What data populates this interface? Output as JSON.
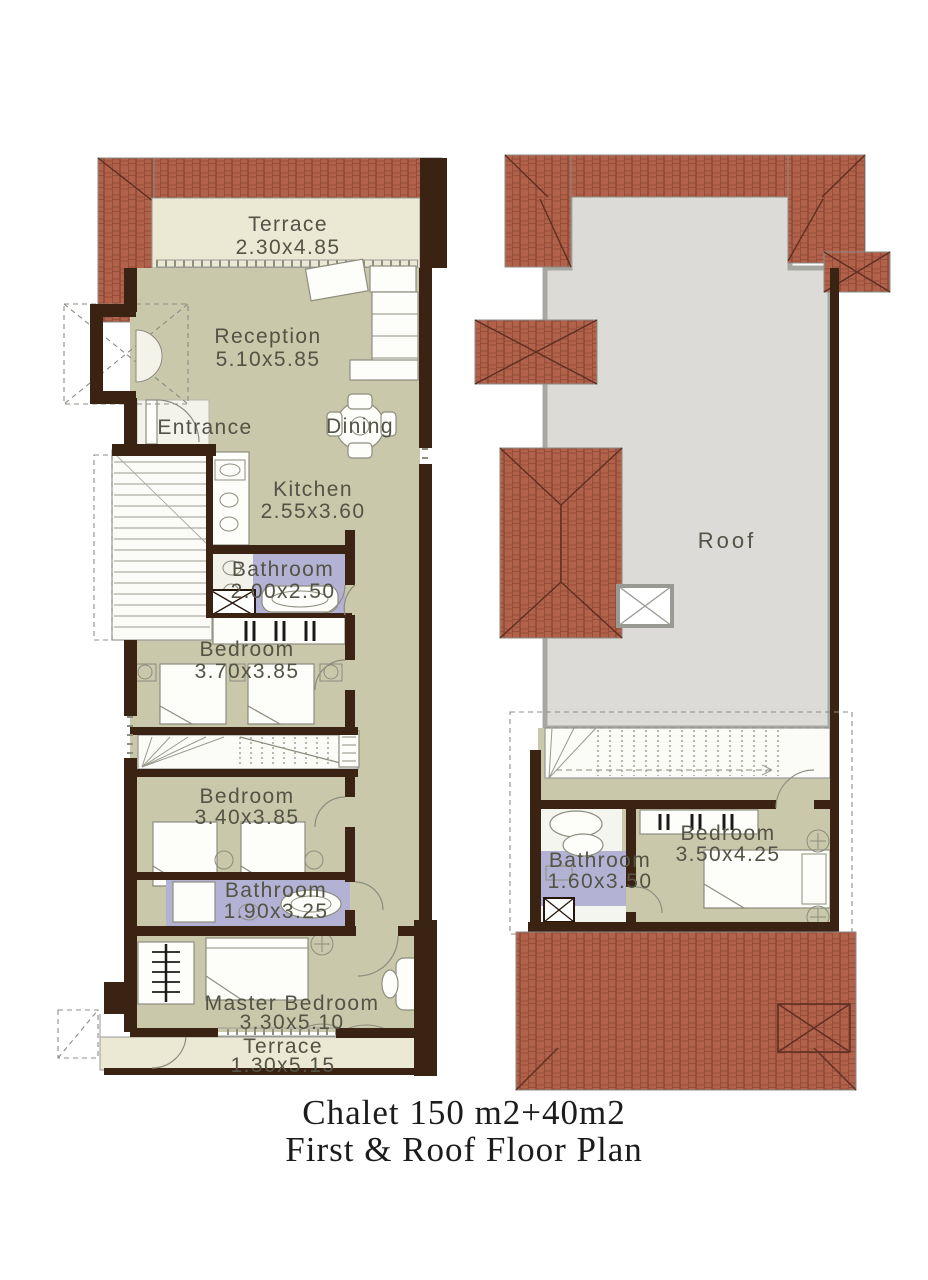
{
  "title": {
    "line1": "Chalet  150 m2+40m2",
    "line2": "First & Roof Floor Plan"
  },
  "first_floor": {
    "terrace_top": {
      "name": "Terrace",
      "dims": "2.30x4.85"
    },
    "reception": {
      "name": "Reception",
      "dims": "5.10x5.85"
    },
    "entrance": {
      "name": "Entrance"
    },
    "dining": {
      "name": "Dining"
    },
    "kitchen": {
      "name": "Kitchen",
      "dims": "2.55x3.60"
    },
    "bathroom_1": {
      "name": "Bathroom",
      "dims": "2.00x2.50"
    },
    "bedroom_1": {
      "name": "Bedroom",
      "dims": "3.70x3.85"
    },
    "bedroom_2": {
      "name": "Bedroom",
      "dims": "3.40x3.85"
    },
    "bathroom_2": {
      "name": "Bathroom",
      "dims": "1.90x3.25"
    },
    "master_bedroom": {
      "name": "Master Bedroom",
      "dims": "3.30x5.10"
    },
    "terrace_bottom": {
      "name": "Terrace",
      "dims": "1.30x5.15"
    }
  },
  "roof_floor": {
    "roof": {
      "name": "Roof"
    },
    "bedroom": {
      "name": "Bedroom",
      "dims": "3.50x4.25"
    },
    "bathroom": {
      "name": "Bathroom",
      "dims": "1.60x3.50"
    }
  },
  "colors": {
    "wall": "#3a2313",
    "floor": "#c9c8aa",
    "terrace": "#ebe9d4",
    "bathroom_floor": "#b3b2d4",
    "brick_roof": "#b2614a",
    "brick_line": "#7a3d2c",
    "roof_slab": "#dcdbd7",
    "roof_edge": "#9a9a95",
    "label_text": "#535346",
    "title_text": "#1c1c1c"
  }
}
